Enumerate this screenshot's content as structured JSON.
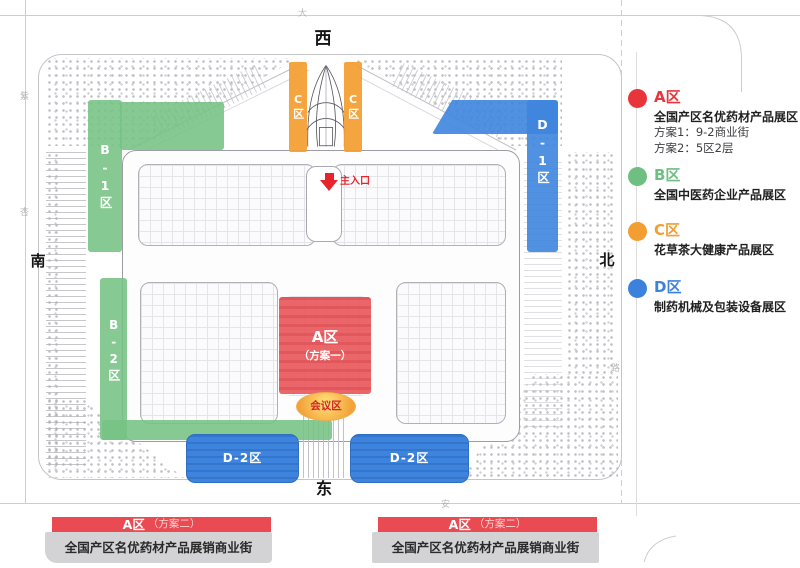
{
  "map": {
    "directions": {
      "west": "西",
      "south": "南",
      "north": "北",
      "east": "东"
    },
    "entrance_label": "主入口",
    "zones": {
      "a_label": "A区",
      "a_sublabel": "（方案一）",
      "b1_label": "B-1区",
      "b2_label": "B-2区",
      "c_label": "C区",
      "d1_label": "D-1区",
      "d2_label": "D-2区",
      "conference_label": "会议区"
    },
    "street_labels": {
      "top": "大",
      "left_upper": "紫",
      "left_lower": "杏",
      "bottom": "安",
      "right": "路"
    }
  },
  "legend": {
    "items": [
      {
        "title": "A区",
        "color": "#e8343b",
        "desc": "全国产区名优药材产品展区",
        "line1": "方案1：9-2商业街",
        "line2": "方案2：5区2层"
      },
      {
        "title": "B区",
        "color": "#6fbe82",
        "desc": "全国中医药企业产品展区"
      },
      {
        "title": "C区",
        "color": "#f29e33",
        "desc": "花草茶大健康产品展区"
      },
      {
        "title": "D区",
        "color": "#3c82dd",
        "desc": "制药机械及包装设备展区"
      }
    ]
  },
  "banners": [
    {
      "title": "A区",
      "subtitle": "（方案二）",
      "body": "全国产区名优药材产品展销商业街"
    },
    {
      "title": "A区",
      "subtitle": "（方案二）",
      "body": "全国产区名优药材产品展销商业街"
    }
  ]
}
